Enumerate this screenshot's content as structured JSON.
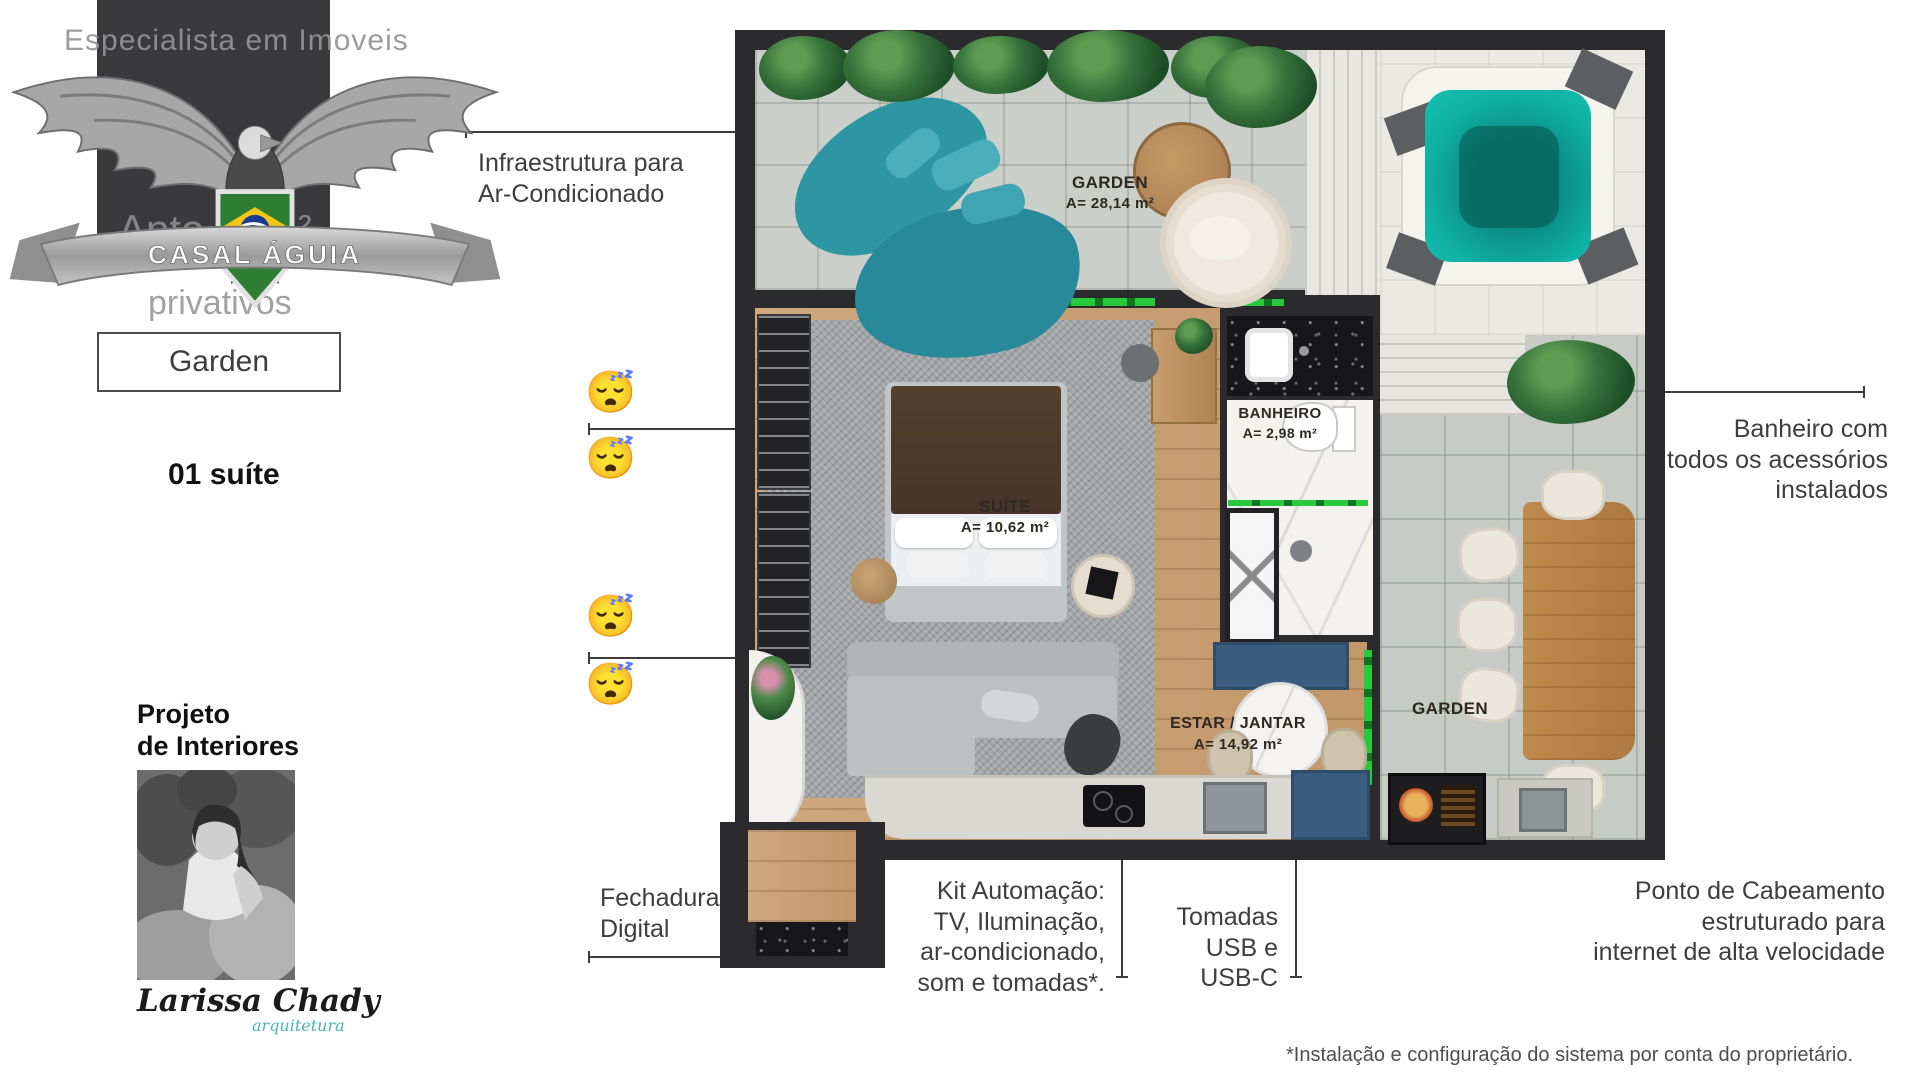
{
  "brand": {
    "watermark_top": "Especialista em Imoveis",
    "watermark_mid": "Apto 63m²",
    "watermark_bottom": "privativos",
    "ribbon": "CASAL ÁGUIA",
    "unit_type": "Garden",
    "unit_features": "01 suíte"
  },
  "interiors": {
    "heading_lines": [
      "Projeto",
      "de Interiores"
    ],
    "signature": "Larissa Chady",
    "signature_sub": "arquitetura"
  },
  "callouts": {
    "sleep_emoji": "😴",
    "ac": {
      "lines": [
        "Infraestrutura para",
        "Ar-Condicionado"
      ]
    },
    "fechadura": {
      "lines": [
        "Fechadura",
        "Digital"
      ]
    },
    "kit": {
      "lines": [
        "Kit Automação:",
        "TV, Iluminação,",
        "ar-condicionado,",
        "som e tomadas*."
      ]
    },
    "tomadas": {
      "lines": [
        "Tomadas",
        "USB e",
        "USB-C"
      ]
    },
    "banheiro": {
      "lines": [
        "Banheiro com",
        "todos os acessórios",
        "instalados"
      ]
    },
    "cabeamento": {
      "lines": [
        "Ponto de Cabeamento",
        "estruturado para",
        "internet de alta velocidade"
      ]
    }
  },
  "plan": {
    "garden_top": {
      "name": "GARDEN",
      "area": "A= 28,14 m²"
    },
    "suite": {
      "name": "SUÍTE",
      "area": "A= 10,62 m²"
    },
    "banheiro": {
      "name": "BANHEIRO",
      "area": "A= 2,98 m²"
    },
    "estar": {
      "name": "ESTAR / JANTAR",
      "area": "A= 14,92 m²"
    },
    "garden_right": {
      "name": "GARDEN"
    }
  },
  "footnote": "*Instalação e configuração do sistema por conta do proprietário.",
  "colors": {
    "wall": "#2b2b2e",
    "wood": "#c49a6c",
    "tile": "#c9cdc9",
    "teal_sofa": "#2e95a3",
    "jacuzzi_water": "#10b2a5",
    "accent_green": "#27c93d",
    "console_blue": "#3a5c7e",
    "signature_teal": "#4ab5ae"
  }
}
